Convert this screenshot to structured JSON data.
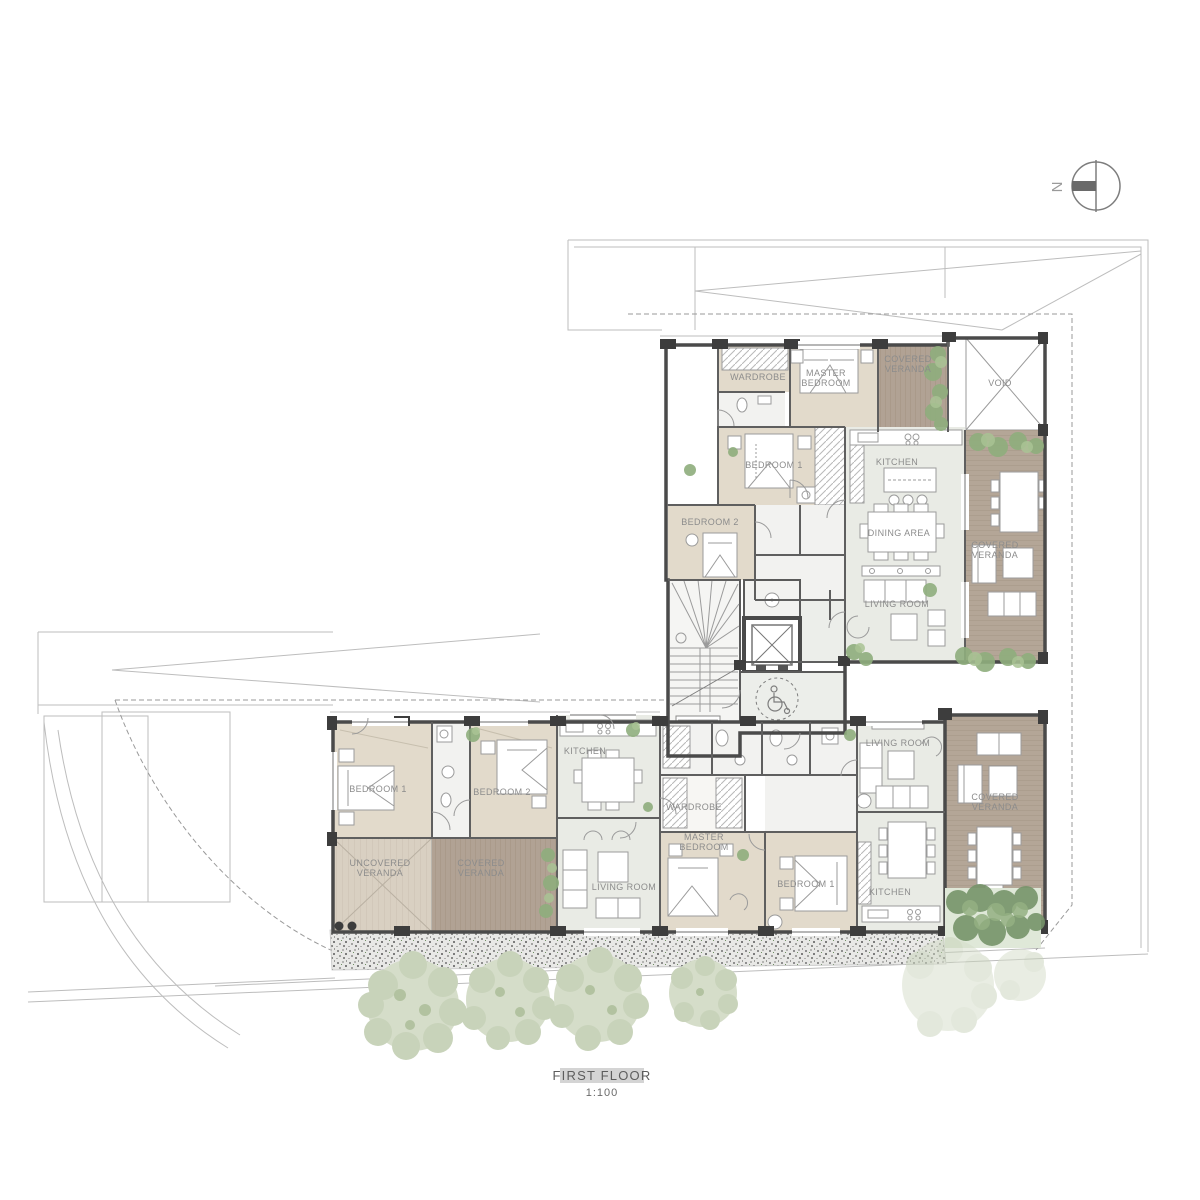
{
  "drawing": {
    "title": "FIRST FLOOR",
    "scale": "1:100",
    "north_label": "N"
  },
  "upper_apartment": {
    "wardrobe": "WARDROBE",
    "master_bedroom": "MASTER BEDROOM",
    "covered_veranda_top": "COVERED VERANDA",
    "void": "VOID",
    "bedroom_1": "BEDROOM 1",
    "kitchen": "KITCHEN",
    "bedroom_2": "BEDROOM 2",
    "dining_area": "DINING AREA",
    "covered_veranda_side": "COVERED VERANDA",
    "living_room": "LIVING ROOM"
  },
  "lower_west_apartment": {
    "bedroom_1": "BEDROOM 1",
    "bedroom_2": "BEDROOM 2",
    "kitchen": "KITCHEN",
    "uncovered_veranda": "UNCOVERED VERANDA",
    "covered_veranda": "COVERED VERANDA",
    "living_room": "LIVING ROOM"
  },
  "lower_east_apartment": {
    "wardrobe": "WARDROBE",
    "master_bedroom": "MASTER BEDROOM",
    "bedroom_1": "BEDROOM 1",
    "living_room": "LIVING ROOM",
    "kitchen": "KITCHEN",
    "covered_veranda": "COVERED VERANDA"
  },
  "colors": {
    "wall": "#4a4a4a",
    "wood_floor": "#e2dacb",
    "deck": "#b1a294",
    "uncovered_deck": "#d9d0c2",
    "tile_floor": "#e9ebe5",
    "plant_green": "#8fae7d",
    "tree_canopy": "#ccd6bf",
    "label_text": "#8c8c8c",
    "title_highlight": "#d4d4d4"
  }
}
